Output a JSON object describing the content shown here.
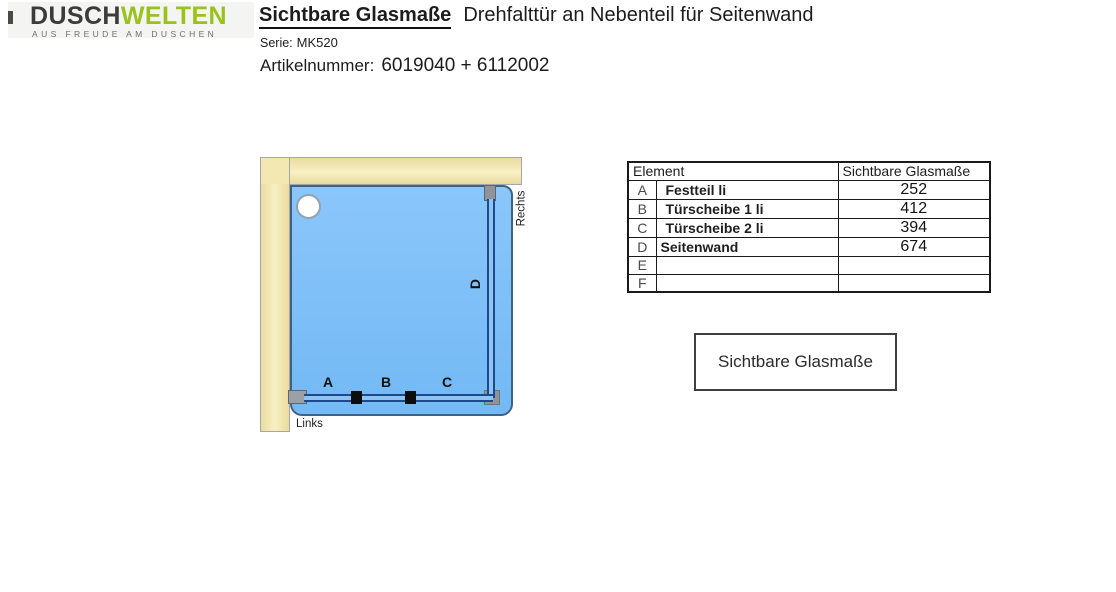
{
  "logo": {
    "brand_part1": "DUSCH",
    "brand_part2": "WELTEN",
    "tagline": "AUS FREUDE AM DUSCHEN",
    "brand_color_dark": "#3c3c3b",
    "brand_color_green": "#9ac21e"
  },
  "header": {
    "title": "Sichtbare Glasmaße",
    "subtitle": "Drehfalttür an Nebenteil für Seitenwand",
    "serie_label": "Serie:",
    "serie_value": "MK520",
    "artikel_label": "Artikelnummer:",
    "artikel_value": "6019040 + 6112002"
  },
  "diagram": {
    "labels": {
      "a": "A",
      "b": "B",
      "c": "C",
      "d": "D",
      "links": "Links",
      "rechts": "Rechts"
    },
    "colors": {
      "wall_beige": "#f2e5ab",
      "floor_blue": "#7fc0f8",
      "glass_dark_blue": "#1d4a8e",
      "bracket_gray": "#8e9499",
      "hinge_black": "#0d0d0d"
    }
  },
  "table": {
    "header": {
      "element": "Element",
      "value": "Sichtbare Glasmaße"
    },
    "rows": [
      {
        "key": "A",
        "name": "Festteil li",
        "value": "252"
      },
      {
        "key": "B",
        "name": "Türscheibe 1 li",
        "value": "412"
      },
      {
        "key": "C",
        "name": "Türscheibe 2 li",
        "value": "394"
      },
      {
        "key": "D",
        "name": "Seitenwand",
        "value": "674"
      },
      {
        "key": "E",
        "name": "",
        "value": ""
      },
      {
        "key": "F",
        "name": "",
        "value": ""
      }
    ]
  },
  "legend_box": {
    "label": "Sichtbare Glasmaße"
  }
}
